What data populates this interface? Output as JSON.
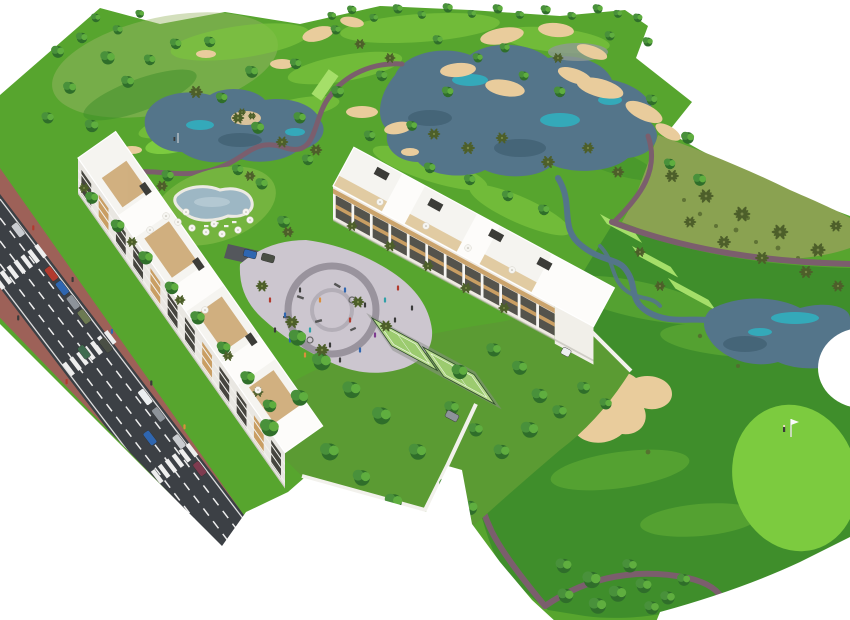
{
  "meta": {
    "title": "Aerial architectural rendering",
    "type": "architectural-aerial-render",
    "description": "Bird's-eye 3D render of a white apartment resort complex beside a golf course with lakes, sand bunkers, cart paths, a pool, a plaza playground, padel courts and an access road with parked cars. No text is rendered in the image."
  },
  "colors": {
    "background": "#ffffff",
    "course_green": "#57a52e",
    "course_light": "#7cc53e",
    "course_pale": "#9db86a",
    "fairway_dark": "#3f8e2b",
    "putting_green": "#7ccb3f",
    "tee_green": "#a5df69",
    "rough_olive": "#8aa251",
    "shrub_dark": "#55682f",
    "sand": "#e9cc9c",
    "sand_edge": "#d2ab72",
    "water": "#54758a",
    "water_dark": "#3c5a6d",
    "water_teal": "#2fb3c2",
    "rock_gray": "#8f9a94",
    "path": "#7b5e6d",
    "road_asphalt": "#3c4045",
    "road_marking": "#eeeeee",
    "sidewalk_brick": "#9d6158",
    "parking_gray": "#54575c",
    "building_white": "#f5f4f0",
    "building_bright": "#fdfcfa",
    "building_shade": "#e9e7e2",
    "building_dark_side": "#d8d6cf",
    "window_dark": "#46453f",
    "wood_accent": "#c99e63",
    "pergola_tan": "#caa36c",
    "deck_tan": "#dcc08f",
    "roof_object_dark": "#3c3c38",
    "slab_white": "#f3f2ee",
    "plaza_paving": "#ccc6cf",
    "plaza_ring": "#8f8a94",
    "garden_green": "#5b9b33",
    "lawn_green": "#74b43f",
    "pool_water": "#9db7c4",
    "pool_light": "#b9ccd6",
    "pool_deck": "#eceae3",
    "court_surface": "#b7db8d",
    "court_inner": "#9ccb6f",
    "court_fence": "#2f4d2a",
    "tree_dark": "#2f6e2a",
    "tree_mid": "#49913b",
    "tree_light": "#5fae3f",
    "palm_frond": "#4d5f2a",
    "wall_white": "#f2f1ec",
    "figure_dark": "#3a3a3a",
    "flag_pole": "#e0e0e0",
    "car_red": "#b23a2e",
    "car_blue": "#2f66b0",
    "car_silver": "#c9ccd0",
    "car_gray": "#8d939a",
    "car_dark": "#4a4f45",
    "car_olive": "#6c7a52",
    "car_white": "#eceff1",
    "car_green": "#3f6b4f",
    "car_maroon": "#7e3b4f"
  },
  "buildings": {
    "west": {
      "bays": 12,
      "floors": 3
    },
    "north": {
      "bays": 12,
      "floors": 3
    }
  },
  "legend": [
    {
      "name": "golf-course",
      "label": "golf course with fairways and rough"
    },
    {
      "name": "lake",
      "label": "irrigation lakes and streams"
    },
    {
      "name": "sand-bunker",
      "label": "sand bunkers"
    },
    {
      "name": "cart-path",
      "label": "golf cart paths"
    },
    {
      "name": "building-west",
      "label": "west apartment block along road"
    },
    {
      "name": "building-north",
      "label": "north apartment block at plaza"
    },
    {
      "name": "plaza",
      "label": "central plaza with playground"
    },
    {
      "name": "swimming-pool",
      "label": "residents swimming pool"
    },
    {
      "name": "padel-courts",
      "label": "padel / tennis courts"
    },
    {
      "name": "access-road",
      "label": "access road with parked cars"
    },
    {
      "name": "putting-green",
      "label": "putting green with flag and golfer"
    }
  ],
  "scene_objects": {
    "trees": [
      [
        332,
        16,
        0.6
      ],
      [
        352,
        10,
        0.65
      ],
      [
        374,
        18,
        0.6
      ],
      [
        398,
        9,
        0.7
      ],
      [
        422,
        15,
        0.6
      ],
      [
        448,
        8,
        0.7
      ],
      [
        472,
        14,
        0.6
      ],
      [
        498,
        9,
        0.7
      ],
      [
        520,
        15,
        0.6
      ],
      [
        546,
        10,
        0.7
      ],
      [
        572,
        16,
        0.6
      ],
      [
        598,
        9,
        0.7
      ],
      [
        618,
        14,
        0.6
      ],
      [
        638,
        18,
        0.65
      ],
      [
        58,
        52,
        0.9
      ],
      [
        82,
        38,
        0.8
      ],
      [
        108,
        58,
        1
      ],
      [
        70,
        88,
        0.9
      ],
      [
        48,
        118,
        0.85
      ],
      [
        92,
        126,
        0.95
      ],
      [
        128,
        82,
        0.9
      ],
      [
        150,
        60,
        0.8
      ],
      [
        176,
        44,
        0.8
      ],
      [
        118,
        30,
        0.7
      ],
      [
        96,
        18,
        0.65
      ],
      [
        140,
        14,
        0.6
      ],
      [
        210,
        42,
        0.8
      ],
      [
        252,
        72,
        0.9
      ],
      [
        296,
        64,
        0.8
      ],
      [
        338,
        92,
        0.9
      ],
      [
        382,
        76,
        0.8
      ],
      [
        300,
        118,
        0.85
      ],
      [
        258,
        128,
        0.9
      ],
      [
        222,
        98,
        0.8
      ],
      [
        448,
        92,
        0.8
      ],
      [
        478,
        58,
        0.7
      ],
      [
        560,
        92,
        0.8
      ],
      [
        524,
        76,
        0.7
      ],
      [
        370,
        136,
        0.8
      ],
      [
        412,
        126,
        0.75
      ],
      [
        336,
        30,
        0.7
      ],
      [
        438,
        40,
        0.7
      ],
      [
        505,
        48,
        0.7
      ],
      [
        652,
        100,
        0.8
      ],
      [
        688,
        138,
        0.9
      ],
      [
        670,
        164,
        0.8
      ],
      [
        700,
        180,
        0.9
      ],
      [
        648,
        42,
        0.7
      ],
      [
        610,
        36,
        0.7
      ],
      [
        430,
        168,
        0.8
      ],
      [
        470,
        180,
        0.8
      ],
      [
        508,
        196,
        0.8
      ],
      [
        544,
        210,
        0.8
      ],
      [
        298,
        338,
        1.2
      ],
      [
        322,
        362,
        1.3
      ],
      [
        352,
        390,
        1.25
      ],
      [
        382,
        416,
        1.3
      ],
      [
        300,
        398,
        1.2
      ],
      [
        270,
        428,
        1.3
      ],
      [
        330,
        452,
        1.3
      ],
      [
        362,
        478,
        1.2
      ],
      [
        394,
        502,
        1.2
      ],
      [
        428,
        520,
        1.1
      ],
      [
        418,
        452,
        1.2
      ],
      [
        448,
        486,
        1.15
      ],
      [
        470,
        508,
        1.1
      ],
      [
        460,
        372,
        1.1
      ],
      [
        494,
        350,
        1
      ],
      [
        520,
        368,
        1.05
      ],
      [
        540,
        396,
        1.1
      ],
      [
        530,
        430,
        1.2
      ],
      [
        502,
        452,
        1.1
      ],
      [
        476,
        430,
        1
      ],
      [
        452,
        408,
        1
      ],
      [
        560,
        412,
        1
      ],
      [
        584,
        388,
        0.9
      ],
      [
        606,
        404,
        0.85
      ],
      [
        564,
        566,
        1.1
      ],
      [
        592,
        580,
        1.25
      ],
      [
        618,
        594,
        1.2
      ],
      [
        644,
        586,
        1.1
      ],
      [
        598,
        606,
        1.2
      ],
      [
        566,
        596,
        1.1
      ],
      [
        668,
        598,
        1
      ],
      [
        684,
        580,
        0.9
      ],
      [
        630,
        566,
        1
      ],
      [
        652,
        608,
        1
      ],
      [
        92,
        198,
        0.9
      ],
      [
        118,
        226,
        0.95
      ],
      [
        146,
        258,
        1
      ],
      [
        172,
        288,
        0.95
      ],
      [
        198,
        318,
        1
      ],
      [
        224,
        348,
        0.95
      ],
      [
        248,
        378,
        1
      ],
      [
        270,
        406,
        0.95
      ],
      [
        168,
        176,
        0.85
      ],
      [
        262,
        184,
        0.85
      ],
      [
        284,
        222,
        0.9
      ],
      [
        238,
        170,
        0.8
      ],
      [
        308,
        160,
        0.8
      ]
    ],
    "palms": [
      [
        196,
        92,
        1
      ],
      [
        238,
        118,
        0.9
      ],
      [
        282,
        142,
        0.9
      ],
      [
        316,
        150,
        0.9
      ],
      [
        434,
        134,
        0.9
      ],
      [
        468,
        148,
        1
      ],
      [
        502,
        138,
        0.9
      ],
      [
        548,
        162,
        1
      ],
      [
        588,
        148,
        0.9
      ],
      [
        618,
        172,
        0.9
      ],
      [
        390,
        58,
        0.8
      ],
      [
        558,
        58,
        0.8
      ],
      [
        360,
        44,
        0.8
      ],
      [
        672,
        176,
        1
      ],
      [
        706,
        196,
        1.1
      ],
      [
        742,
        214,
        1.2
      ],
      [
        780,
        232,
        1.2
      ],
      [
        818,
        250,
        1.1
      ],
      [
        690,
        222,
        0.9
      ],
      [
        724,
        242,
        1
      ],
      [
        762,
        258,
        1
      ],
      [
        806,
        272,
        1
      ],
      [
        838,
        286,
        0.9
      ],
      [
        836,
        226,
        0.9
      ],
      [
        84,
        188,
        0.8
      ],
      [
        132,
        242,
        0.8
      ],
      [
        180,
        300,
        0.8
      ],
      [
        228,
        356,
        0.8
      ],
      [
        258,
        392,
        0.8
      ],
      [
        162,
        186,
        0.85
      ],
      [
        250,
        176,
        0.8
      ],
      [
        288,
        232,
        0.85
      ],
      [
        262,
        286,
        0.9
      ],
      [
        292,
        322,
        1
      ],
      [
        322,
        350,
        1
      ],
      [
        358,
        302,
        0.9
      ],
      [
        386,
        326,
        0.9
      ],
      [
        352,
        226,
        0.8
      ],
      [
        390,
        246,
        0.85
      ],
      [
        428,
        266,
        0.85
      ],
      [
        466,
        288,
        0.85
      ],
      [
        504,
        308,
        0.85
      ],
      [
        640,
        252,
        0.8
      ],
      [
        660,
        286,
        0.8
      ],
      [
        242,
        112,
        0.6
      ],
      [
        252,
        116,
        0.6
      ]
    ],
    "parasols": [
      [
        178,
        222
      ],
      [
        192,
        228
      ],
      [
        206,
        232
      ],
      [
        222,
        234
      ],
      [
        238,
        230
      ],
      [
        250,
        220
      ],
      [
        186,
        212
      ],
      [
        246,
        212
      ],
      [
        166,
        216
      ],
      [
        214,
        224
      ],
      [
        150,
        230
      ],
      [
        205,
        310
      ],
      [
        258,
        390
      ],
      [
        380,
        202
      ],
      [
        426,
        226
      ],
      [
        468,
        248
      ],
      [
        512,
        270
      ]
    ],
    "cars": [
      {
        "x": 18.2,
        "y": 229.9,
        "rot": 52.8,
        "len": 15,
        "color": "car_silver"
      },
      {
        "x": 51.4,
        "y": 273.7,
        "rot": 52.8,
        "len": 15,
        "color": "car_red"
      },
      {
        "x": 62.3,
        "y": 288.0,
        "rot": 52.8,
        "len": 15,
        "color": "car_blue"
      },
      {
        "x": 73.2,
        "y": 302.3,
        "rot": 52.8,
        "len": 15,
        "color": "car_gray"
      },
      {
        "x": 84.1,
        "y": 316.6,
        "rot": 52.8,
        "len": 15,
        "color": "car_olive"
      },
      {
        "x": 105.9,
        "y": 345.3,
        "rot": 52.8,
        "len": 15,
        "color": "car_dark"
      },
      {
        "x": 145.2,
        "y": 397.0,
        "rot": 52.8,
        "len": 17,
        "color": "car_white"
      },
      {
        "x": 158.5,
        "y": 414.5,
        "rot": 52.8,
        "len": 15,
        "color": "car_gray"
      },
      {
        "x": 179.1,
        "y": 441.6,
        "rot": 52.8,
        "len": 15,
        "color": "car_silver"
      },
      {
        "x": 199.7,
        "y": 468.7,
        "rot": 52.8,
        "len": 15,
        "color": "car_maroon"
      },
      {
        "x": 84.0,
        "y": 352.0,
        "rot": 52.8,
        "len": 14,
        "color": "car_green"
      },
      {
        "x": 150.0,
        "y": 438.0,
        "rot": 52.8,
        "len": 15,
        "color": "car_blue"
      },
      {
        "x": 250.0,
        "y": 254.0,
        "rot": 15,
        "len": 13,
        "color": "car_blue"
      },
      {
        "x": 268.0,
        "y": 258.0,
        "rot": 15,
        "len": 13,
        "color": "car_dark"
      },
      {
        "x": 452.0,
        "y": 416.0,
        "rot": 28,
        "len": 13,
        "color": "car_gray"
      },
      {
        "x": 566.0,
        "y": 352.0,
        "rot": 28,
        "len": 9,
        "color": "car_white"
      }
    ],
    "people_road": [
      [
        33.3,
        227.8,
        "#b23a2e"
      ],
      [
        72.6,
        279.5,
        "#3a3a3a"
      ],
      [
        111.9,
        331.3,
        "#2f66b0"
      ],
      [
        151.3,
        383.0,
        "#3a3a3a"
      ],
      [
        184.5,
        426.8,
        "#d98f3c"
      ],
      [
        18.2,
        317.9,
        "#3a3a3a"
      ],
      [
        66.6,
        381.6,
        "#b23a2e"
      ],
      [
        115.0,
        445.2,
        "#3a3a3a"
      ],
      [
        154.3,
        497.0,
        "#2f66b0"
      ]
    ],
    "people_plaza": [
      [
        270,
        300,
        "#b23a2e"
      ],
      [
        285,
        315,
        "#2f66b0"
      ],
      [
        300,
        290,
        "#3a3a3a"
      ],
      [
        310,
        330,
        "#2fa0a8"
      ],
      [
        320,
        300,
        "#d98f3c"
      ],
      [
        330,
        345,
        "#3a3a3a"
      ],
      [
        345,
        290,
        "#2f66b0"
      ],
      [
        350,
        320,
        "#b23a2e"
      ],
      [
        365,
        305,
        "#3a3a3a"
      ],
      [
        375,
        335,
        "#7e3b8f"
      ],
      [
        385,
        300,
        "#2fa0a8"
      ],
      [
        395,
        320,
        "#3a3a3a"
      ],
      [
        405,
        340,
        "#b23a2e"
      ],
      [
        290,
        340,
        "#2f66b0"
      ],
      [
        305,
        355,
        "#d98f3c"
      ],
      [
        340,
        360,
        "#3a3a3a"
      ],
      [
        360,
        350,
        "#2f66b0"
      ],
      [
        275,
        330,
        "#3a3a3a"
      ],
      [
        398,
        288,
        "#b23a2e"
      ],
      [
        412,
        308,
        "#3a3a3a"
      ]
    ]
  }
}
